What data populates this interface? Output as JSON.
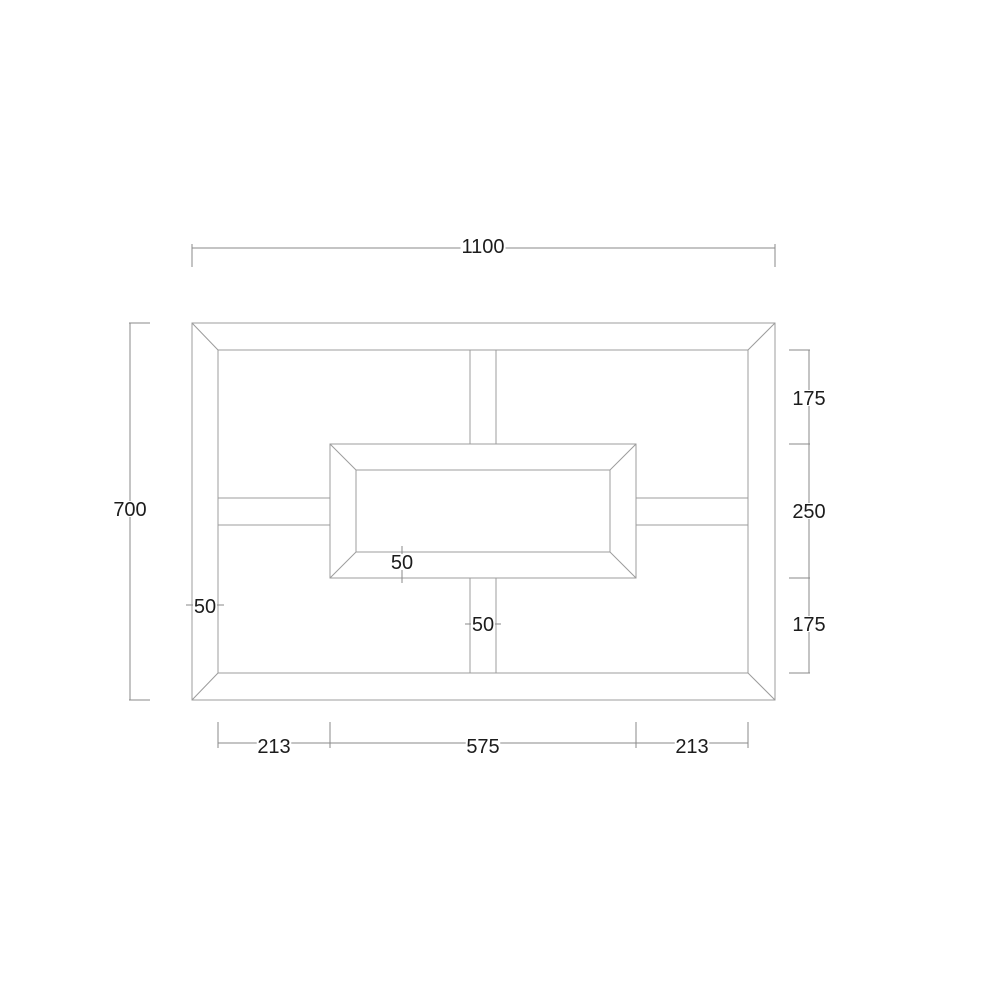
{
  "canvas": {
    "width": 1000,
    "height": 1000,
    "background": "#ffffff"
  },
  "style": {
    "object_line_color": "#9c9c9c",
    "dim_line_color": "#8a8a8a",
    "text_color": "#1c1c1c",
    "label_background": "#ffffff",
    "label_font_size": 20
  },
  "dimensions_summary": {
    "overall_width": "1100",
    "overall_height": "700",
    "right_segments": [
      "175",
      "250",
      "175"
    ],
    "bottom_segments": [
      "213",
      "575",
      "213"
    ],
    "frame_thickness": "50",
    "box_thickness": "50",
    "divider_thickness": "50"
  },
  "geometry": {
    "rects": [
      {
        "name": "outer-frame-outline",
        "x": 192,
        "y": 323,
        "w": 583,
        "h": 377
      },
      {
        "name": "outer-frame-inner-outline",
        "x": 218,
        "y": 350,
        "w": 530,
        "h": 323
      },
      {
        "name": "center-box-outline",
        "x": 330,
        "y": 444,
        "w": 306,
        "h": 134
      },
      {
        "name": "center-box-inner-outline",
        "x": 356,
        "y": 470,
        "w": 254,
        "h": 82
      }
    ],
    "lines": [
      {
        "name": "frame-miter-top-left",
        "x1": 192,
        "y1": 323,
        "x2": 218,
        "y2": 350
      },
      {
        "name": "frame-miter-top-right",
        "x1": 775,
        "y1": 323,
        "x2": 748,
        "y2": 350
      },
      {
        "name": "frame-miter-bottom-right",
        "x1": 775,
        "y1": 700,
        "x2": 748,
        "y2": 673
      },
      {
        "name": "frame-miter-bottom-left",
        "x1": 192,
        "y1": 700,
        "x2": 218,
        "y2": 673
      },
      {
        "name": "box-miter-top-left",
        "x1": 330,
        "y1": 444,
        "x2": 356,
        "y2": 470
      },
      {
        "name": "box-miter-top-right",
        "x1": 636,
        "y1": 444,
        "x2": 610,
        "y2": 470
      },
      {
        "name": "box-miter-bottom-right",
        "x1": 636,
        "y1": 578,
        "x2": 610,
        "y2": 552
      },
      {
        "name": "box-miter-bottom-left",
        "x1": 330,
        "y1": 578,
        "x2": 356,
        "y2": 552
      },
      {
        "name": "top-divider-left-edge",
        "x1": 470,
        "y1": 350,
        "x2": 470,
        "y2": 444
      },
      {
        "name": "top-divider-right-edge",
        "x1": 496,
        "y1": 350,
        "x2": 496,
        "y2": 444
      },
      {
        "name": "bottom-divider-left-edge",
        "x1": 470,
        "y1": 578,
        "x2": 470,
        "y2": 673
      },
      {
        "name": "bottom-divider-right-edge",
        "x1": 496,
        "y1": 578,
        "x2": 496,
        "y2": 673
      },
      {
        "name": "left-shelf-top-edge",
        "x1": 218,
        "y1": 498,
        "x2": 330,
        "y2": 498
      },
      {
        "name": "left-shelf-bottom-edge",
        "x1": 218,
        "y1": 525,
        "x2": 330,
        "y2": 525
      },
      {
        "name": "right-shelf-top-edge",
        "x1": 636,
        "y1": 498,
        "x2": 748,
        "y2": 498
      },
      {
        "name": "right-shelf-bottom-edge",
        "x1": 636,
        "y1": 525,
        "x2": 748,
        "y2": 525
      }
    ],
    "dim_lines": [
      {
        "name": "dim-top-line",
        "x1": 192,
        "y1": 248,
        "x2": 775,
        "y2": 248
      },
      {
        "name": "dim-top-tick-left",
        "x1": 192,
        "y1": 244,
        "x2": 192,
        "y2": 267
      },
      {
        "name": "dim-top-tick-right",
        "x1": 775,
        "y1": 244,
        "x2": 775,
        "y2": 267
      },
      {
        "name": "dim-left-line",
        "x1": 130,
        "y1": 323,
        "x2": 130,
        "y2": 700
      },
      {
        "name": "dim-left-tick-top",
        "x1": 129,
        "y1": 323,
        "x2": 150,
        "y2": 323
      },
      {
        "name": "dim-left-tick-bottom",
        "x1": 129,
        "y1": 700,
        "x2": 150,
        "y2": 700
      },
      {
        "name": "dim-right-line",
        "x1": 809,
        "y1": 350,
        "x2": 809,
        "y2": 673
      },
      {
        "name": "dim-right-tick-1",
        "x1": 789,
        "y1": 350,
        "x2": 810,
        "y2": 350
      },
      {
        "name": "dim-right-tick-2",
        "x1": 789,
        "y1": 444,
        "x2": 810,
        "y2": 444
      },
      {
        "name": "dim-right-tick-3",
        "x1": 789,
        "y1": 578,
        "x2": 810,
        "y2": 578
      },
      {
        "name": "dim-right-tick-4",
        "x1": 789,
        "y1": 673,
        "x2": 810,
        "y2": 673
      },
      {
        "name": "dim-bottom-line",
        "x1": 218,
        "y1": 743,
        "x2": 748,
        "y2": 743
      },
      {
        "name": "dim-bottom-tick-1",
        "x1": 218,
        "y1": 722,
        "x2": 218,
        "y2": 748
      },
      {
        "name": "dim-bottom-tick-2",
        "x1": 330,
        "y1": 722,
        "x2": 330,
        "y2": 748
      },
      {
        "name": "dim-bottom-tick-3",
        "x1": 636,
        "y1": 722,
        "x2": 636,
        "y2": 748
      },
      {
        "name": "dim-bottom-tick-4",
        "x1": 748,
        "y1": 722,
        "x2": 748,
        "y2": 748
      },
      {
        "name": "dim-frame-thickness-line",
        "x1": 186,
        "y1": 605,
        "x2": 224,
        "y2": 605
      },
      {
        "name": "dim-box-thickness-line",
        "x1": 402,
        "y1": 546,
        "x2": 402,
        "y2": 583
      },
      {
        "name": "dim-divider-thickness-line",
        "x1": 465,
        "y1": 624,
        "x2": 501,
        "y2": 624
      }
    ],
    "labels": [
      {
        "name": "dim-label-overall-width",
        "text": "1100",
        "x": 483,
        "y": 246
      },
      {
        "name": "dim-label-overall-height",
        "text": "700",
        "x": 130,
        "y": 509
      },
      {
        "name": "dim-label-right-top",
        "text": "175",
        "x": 809,
        "y": 398
      },
      {
        "name": "dim-label-right-middle",
        "text": "250",
        "x": 809,
        "y": 511
      },
      {
        "name": "dim-label-right-bottom",
        "text": "175",
        "x": 809,
        "y": 624
      },
      {
        "name": "dim-label-bottom-left",
        "text": "213",
        "x": 274,
        "y": 746
      },
      {
        "name": "dim-label-bottom-center",
        "text": "575",
        "x": 483,
        "y": 746
      },
      {
        "name": "dim-label-bottom-right",
        "text": "213",
        "x": 692,
        "y": 746
      },
      {
        "name": "dim-label-frame-thickness",
        "text": "50",
        "x": 205,
        "y": 606
      },
      {
        "name": "dim-label-box-thickness",
        "text": "50",
        "x": 402,
        "y": 562
      },
      {
        "name": "dim-label-divider-thickness",
        "text": "50",
        "x": 483,
        "y": 624
      }
    ]
  }
}
